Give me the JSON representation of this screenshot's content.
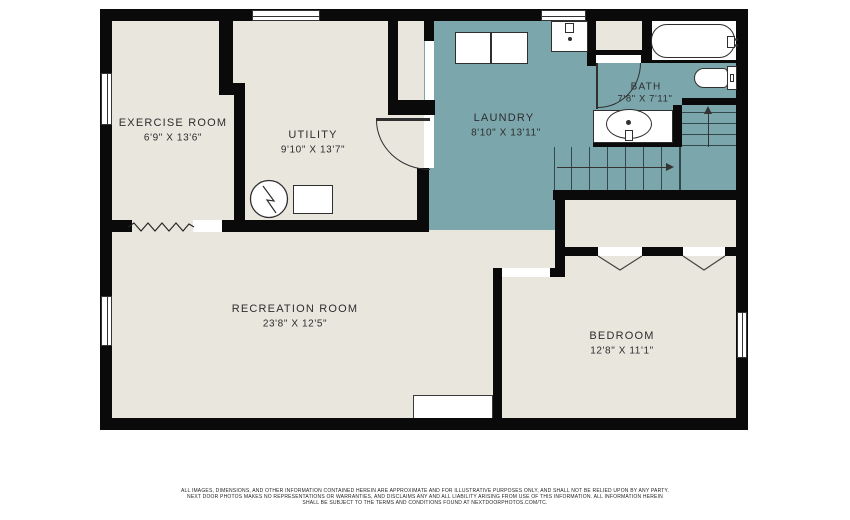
{
  "plan_title": "basement-floor-plan",
  "rooms": {
    "exercise": {
      "name": "EXERCISE ROOM",
      "dims": "6'9\" X 13'6\""
    },
    "utility": {
      "name": "UTILITY",
      "dims": "9'10\" X 13'7\""
    },
    "laundry": {
      "name": "LAUNDRY",
      "dims": "8'10\" X 13'11\""
    },
    "bath": {
      "name": "BATH",
      "dims": "7'8\" X 7'11\""
    },
    "recreation": {
      "name": "RECREATION ROOM",
      "dims": "23'8\" X 12'5\""
    },
    "bedroom": {
      "name": "BEDROOM",
      "dims": "12'8\" X 11'1\""
    }
  },
  "colors": {
    "wall": "#0a0a0a",
    "floor": "#e9e6de",
    "wet": "#7ba6ac",
    "line": "#2f2f2f"
  },
  "fixtures": [
    "bathtub",
    "toilet",
    "vanity-sink",
    "laundry-sink",
    "washer",
    "dryer",
    "water-heater",
    "furnace",
    "l-staircase-up",
    "closet-bifold-doors",
    "windows"
  ],
  "stairs": {
    "direction": "up"
  },
  "disclaimer": {
    "line1": "ALL IMAGES, DIMENSIONS, AND OTHER INFORMATION CONTAINED HEREIN ARE APPROXIMATE AND FOR ILLUSTRATIVE PURPOSES ONLY, AND SHALL NOT BE RELIED UPON BY ANY PARTY.",
    "line2": "NEXT DOOR PHOTOS MAKES NO REPRESENTATIONS OR WARRANTIES, AND DISCLAIMS ANY AND ALL LIABILITY ARISING FROM USE OF THIS INFORMATION. ALL INFORMATION HEREIN",
    "line3": "SHALL BE SUBJECT TO THE TERMS AND CONDITIONS FOUND AT NEXTDOORPHOTOS.COM/TC."
  }
}
